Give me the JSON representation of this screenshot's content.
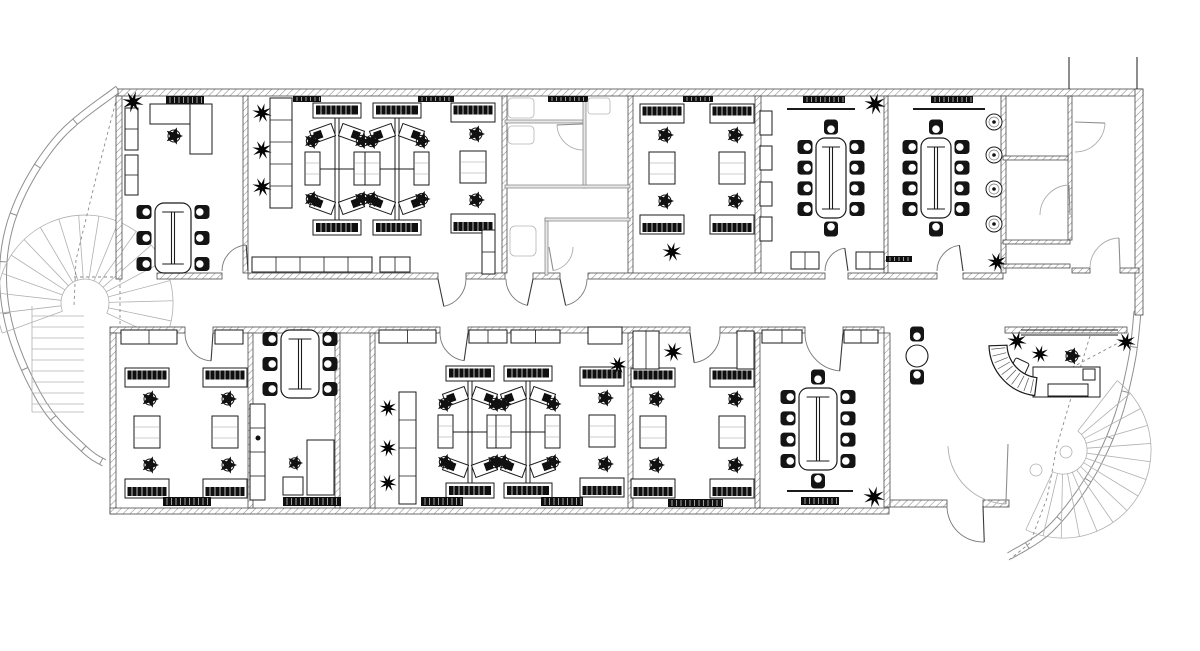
{
  "drawing": {
    "kind": "office-floor-plan-cad",
    "canvas": {
      "w": 1200,
      "h": 651
    },
    "colors": {
      "ink": "#1b1b1b",
      "wallEdge": "#4a4a4a",
      "hatch": "#8c8c8c",
      "light": "#a6a6a6",
      "faint": "#c2c2c2",
      "dark": "#0f0f0f",
      "bg": "#ffffff"
    },
    "walls": [
      [
        118,
        89,
        1025,
        7
      ],
      [
        116,
        96,
        6,
        183
      ],
      [
        243,
        96,
        5,
        177
      ],
      [
        502,
        96,
        5,
        177
      ],
      [
        628,
        96,
        5,
        177
      ],
      [
        755,
        96,
        6,
        177
      ],
      [
        884,
        96,
        4,
        177
      ],
      [
        1001,
        96,
        5,
        177
      ],
      [
        1135,
        89,
        8,
        226
      ],
      [
        1068,
        96,
        4,
        144
      ],
      [
        1003,
        156,
        65,
        4
      ],
      [
        1003,
        240,
        67,
        4
      ],
      [
        1003,
        264,
        67,
        4
      ],
      [
        1072,
        268,
        18,
        5
      ],
      [
        1120,
        268,
        19,
        5
      ],
      [
        157,
        273,
        65,
        6
      ],
      [
        248,
        273,
        190,
        6
      ],
      [
        466,
        273,
        39,
        6
      ],
      [
        533,
        273,
        27,
        6
      ],
      [
        588,
        273,
        237,
        6
      ],
      [
        848,
        273,
        89,
        6
      ],
      [
        963,
        273,
        40,
        6
      ],
      [
        110,
        327,
        75,
        6
      ],
      [
        213,
        327,
        227,
        6
      ],
      [
        468,
        327,
        222,
        6
      ],
      [
        720,
        327,
        85,
        6
      ],
      [
        843,
        327,
        41,
        6
      ],
      [
        1005,
        327,
        122,
        6
      ],
      [
        110,
        333,
        6,
        181
      ],
      [
        110,
        508,
        779,
        6
      ],
      [
        887,
        500,
        60,
        7
      ],
      [
        983,
        500,
        26,
        7
      ],
      [
        248,
        333,
        5,
        175
      ],
      [
        335,
        333,
        5,
        175
      ],
      [
        370,
        333,
        5,
        175
      ],
      [
        628,
        333,
        5,
        175
      ],
      [
        755,
        333,
        5,
        175
      ],
      [
        884,
        333,
        6,
        174
      ]
    ],
    "lightWalls": [
      [
        505,
        120,
        78,
        3
      ],
      [
        583,
        96,
        3,
        92
      ],
      [
        505,
        185,
        125,
        3
      ],
      [
        545,
        218,
        3,
        57
      ],
      [
        545,
        218,
        85,
        3
      ]
    ],
    "lines": [
      [
        787,
        109,
        855,
        109,
        2
      ],
      [
        913,
        109,
        985,
        109,
        2
      ],
      [
        787,
        491,
        853,
        491,
        2
      ],
      [
        1021,
        330,
        1118,
        330,
        1
      ],
      [
        1021,
        335,
        1118,
        335,
        1
      ],
      [
        1069,
        57,
        1069,
        89,
        1
      ],
      [
        1137,
        57,
        1137,
        89,
        1
      ]
    ],
    "lightLines": [
      [
        32,
        306,
        32,
        412
      ],
      [
        32,
        412,
        84,
        412
      ]
    ],
    "doors": [
      [
        248,
        271,
        26,
        180,
        266,
        0
      ],
      [
        438,
        279,
        28,
        0,
        78,
        0
      ],
      [
        533,
        279,
        27,
        180,
        102,
        0
      ],
      [
        560,
        279,
        27,
        0,
        78,
        0
      ],
      [
        848,
        271,
        23,
        180,
        262,
        0
      ],
      [
        963,
        271,
        26,
        180,
        262,
        0
      ],
      [
        213,
        333,
        28,
        180,
        94,
        0
      ],
      [
        468,
        333,
        28,
        180,
        98,
        0
      ],
      [
        690,
        333,
        30,
        0,
        82,
        0
      ],
      [
        843,
        333,
        38,
        180,
        95,
        0
      ],
      [
        983,
        506,
        36,
        180,
        88,
        0
      ],
      [
        1075,
        122,
        30,
        90,
        2,
        1
      ],
      [
        1070,
        215,
        30,
        180,
        268,
        1
      ],
      [
        1120,
        268,
        30,
        180,
        268,
        1
      ],
      [
        1008,
        444,
        60,
        178,
        92,
        1
      ],
      [
        583,
        124,
        26,
        90,
        178,
        1
      ],
      [
        549,
        247,
        24,
        0,
        80,
        1
      ]
    ],
    "dashes": [
      [
        [
          117,
          97
        ],
        [
          96,
          178
        ],
        [
          76,
          260
        ],
        [
          74,
          306
        ]
      ],
      [
        [
          74,
          277
        ],
        [
          120,
          277
        ],
        [
          120,
          329
        ]
      ],
      [
        [
          1090,
          336
        ],
        [
          1071,
          398
        ],
        [
          1057,
          446
        ],
        [
          1047,
          498
        ],
        [
          1030,
          543
        ],
        [
          1009,
          560
        ]
      ],
      [
        [
          1122,
          341
        ],
        [
          1048,
          380
        ]
      ]
    ],
    "glaze": [
      {
        "pts": [
          [
            120,
            92
          ],
          [
            63,
            138
          ],
          [
            23,
            200
          ],
          [
            7,
            262
          ],
          [
            14,
            330
          ],
          [
            46,
            402
          ],
          [
            86,
            446
          ],
          [
            106,
            460
          ]
        ],
        "gap": 7,
        "tick": 6
      },
      {
        "pts": [
          [
            1141,
            312
          ],
          [
            1135,
            362
          ],
          [
            1119,
            424
          ],
          [
            1091,
            482
          ],
          [
            1052,
            532
          ],
          [
            1011,
            559
          ]
        ],
        "gap": 7,
        "tick": 6
      }
    ],
    "fans": [
      {
        "cx": 85,
        "cy": 303,
        "r0": 24,
        "r1": 88,
        "a0": 160,
        "a1": 385,
        "n": 17
      },
      {
        "cx": 1063,
        "cy": 450,
        "r0": 24,
        "r1": 88,
        "a0": -52,
        "a1": 115,
        "n": 14
      }
    ],
    "treadRuns": [
      {
        "x": 32,
        "y": 316,
        "w": 52,
        "step": 11,
        "n": 9
      }
    ],
    "pods": [
      [
        305,
        103
      ],
      [
        365,
        103
      ],
      [
        438,
        366
      ],
      [
        496,
        366
      ]
    ],
    "vrows": [
      [
        451,
        103
      ],
      [
        640,
        104
      ],
      [
        710,
        104
      ],
      [
        580,
        367
      ],
      [
        631,
        368
      ],
      [
        710,
        368
      ],
      [
        125,
        368
      ],
      [
        203,
        368
      ]
    ],
    "confs": [
      [
        816,
        138,
        30,
        80,
        4,
        1
      ],
      [
        921,
        138,
        30,
        80,
        4,
        1
      ],
      [
        799,
        388,
        38,
        82,
        4,
        1
      ],
      [
        155,
        203,
        36,
        70,
        3,
        0
      ],
      [
        281,
        330,
        38,
        68,
        3,
        0
      ]
    ],
    "chairs": [
      [
        174,
        136,
        9
      ],
      [
        295,
        463,
        8
      ],
      [
        1072,
        356,
        9
      ]
    ],
    "cchairs": [
      [
        917,
        334,
        90
      ],
      [
        917,
        377,
        270
      ]
    ],
    "plants": [
      [
        133,
        102,
        11
      ],
      [
        262,
        113,
        10
      ],
      [
        262,
        150,
        10
      ],
      [
        262,
        187,
        10
      ],
      [
        875,
        104,
        11
      ],
      [
        997,
        262,
        10
      ],
      [
        672,
        252,
        10
      ],
      [
        388,
        408,
        9
      ],
      [
        388,
        448,
        9
      ],
      [
        388,
        483,
        9
      ],
      [
        618,
        365,
        9
      ],
      [
        673,
        352,
        10
      ],
      [
        874,
        497,
        11
      ],
      [
        1017,
        341,
        10
      ],
      [
        1126,
        342,
        10
      ],
      [
        1040,
        354,
        9
      ]
    ],
    "planters": [
      [
        994,
        122
      ],
      [
        994,
        155
      ],
      [
        994,
        189
      ],
      [
        994,
        224
      ]
    ],
    "cabs": [
      [
        125,
        108,
        13,
        42,
        1,
        2
      ],
      [
        125,
        155,
        13,
        40,
        1,
        2
      ],
      [
        270,
        98,
        22,
        110,
        4,
        2
      ],
      [
        252,
        257,
        120,
        15,
        4,
        1
      ],
      [
        380,
        257,
        30,
        15,
        1,
        1
      ],
      [
        482,
        230,
        13,
        44,
        1,
        2
      ],
      [
        760,
        111,
        12,
        24,
        0,
        0
      ],
      [
        760,
        146,
        12,
        24,
        0,
        0
      ],
      [
        760,
        182,
        12,
        24,
        0,
        0
      ],
      [
        760,
        217,
        12,
        24,
        0,
        0
      ],
      [
        791,
        252,
        28,
        17,
        1,
        1
      ],
      [
        856,
        252,
        28,
        17,
        1,
        1
      ],
      [
        121,
        330,
        56,
        14,
        1,
        1
      ],
      [
        215,
        330,
        28,
        14,
        0,
        0
      ],
      [
        379,
        330,
        57,
        13,
        1,
        1
      ],
      [
        469,
        330,
        38,
        13,
        1,
        1
      ],
      [
        511,
        330,
        49,
        13,
        1,
        1
      ],
      [
        250,
        404,
        15,
        96,
        3,
        2
      ],
      [
        399,
        392,
        17,
        112,
        3,
        2
      ],
      [
        633,
        331,
        26,
        38,
        1,
        1
      ],
      [
        737,
        331,
        17,
        38,
        0,
        0
      ],
      [
        762,
        330,
        40,
        13,
        1,
        1
      ],
      [
        844,
        330,
        34,
        13,
        1,
        1
      ],
      [
        283,
        477,
        20,
        18,
        0,
        0
      ]
    ],
    "darks": [
      [
        166,
        96,
        38,
        8
      ],
      [
        293,
        96,
        28,
        6
      ],
      [
        418,
        96,
        36,
        6
      ],
      [
        548,
        96,
        40,
        6
      ],
      [
        683,
        96,
        30,
        6
      ],
      [
        803,
        96,
        42,
        7
      ],
      [
        931,
        96,
        42,
        7
      ],
      [
        886,
        256,
        26,
        6
      ],
      [
        163,
        497,
        48,
        9
      ],
      [
        283,
        497,
        58,
        9
      ],
      [
        421,
        497,
        42,
        9
      ],
      [
        541,
        497,
        42,
        9
      ],
      [
        668,
        499,
        55,
        8
      ],
      [
        801,
        497,
        38,
        8
      ],
      [
        594,
        330,
        17,
        11
      ],
      [
        310,
        455,
        20,
        16
      ],
      [
        156,
        107,
        18,
        11
      ],
      [
        192,
        126,
        14,
        14
      ],
      [
        1060,
        368,
        20,
        12
      ]
    ],
    "rects": [
      [
        150,
        104,
        62,
        20,
        0,
        0,
        0
      ],
      [
        190,
        104,
        22,
        50,
        0,
        0,
        0
      ],
      [
        588,
        327,
        34,
        17,
        0,
        0,
        0
      ],
      [
        307,
        440,
        27,
        55,
        0,
        0,
        0
      ],
      [
        1033,
        367,
        67,
        30,
        0,
        0,
        0
      ],
      [
        1048,
        384,
        40,
        12,
        0,
        0,
        0
      ],
      [
        1083,
        369,
        12,
        11,
        0,
        0,
        0
      ],
      [
        1012,
        360,
        15,
        15,
        25,
        0,
        2
      ],
      [
        508,
        98,
        26,
        20,
        0,
        1,
        4
      ],
      [
        508,
        126,
        26,
        18,
        0,
        1,
        4
      ],
      [
        588,
        98,
        22,
        16,
        0,
        1,
        3
      ],
      [
        510,
        226,
        26,
        30,
        0,
        1,
        5
      ]
    ],
    "circles": [
      [
        917,
        356,
        11,
        0
      ],
      [
        1066,
        452,
        6,
        1
      ],
      [
        1036,
        470,
        6,
        1
      ],
      [
        258,
        438,
        2.5,
        2
      ]
    ],
    "rdesk": {
      "cx": 1041,
      "cy": 344,
      "r0": 34,
      "r1": 52,
      "a0": 97,
      "a1": 178
    }
  }
}
